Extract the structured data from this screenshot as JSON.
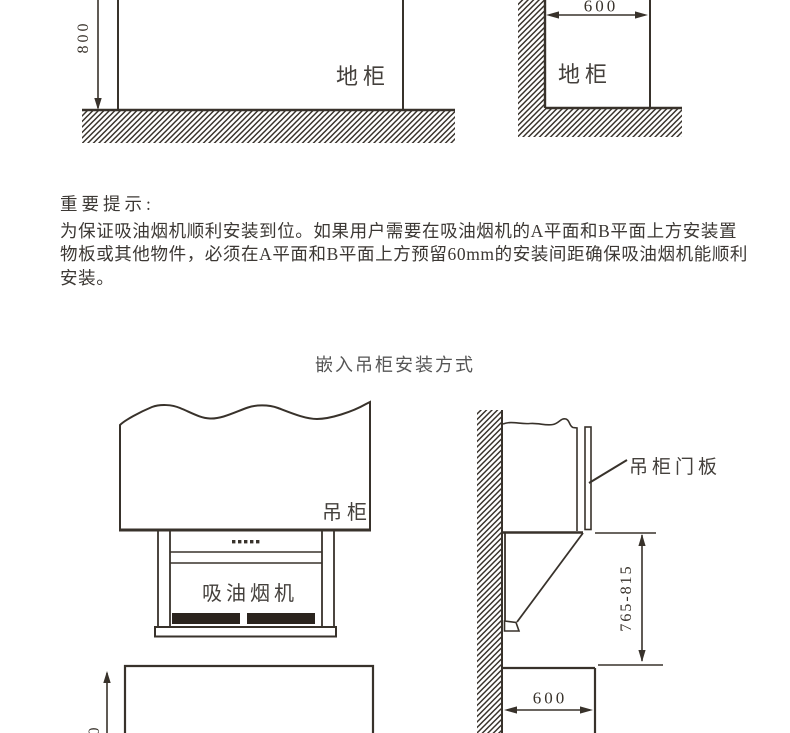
{
  "section_heading": "嵌入吊柜安装方式",
  "notice": {
    "title": "重要提示:",
    "lines": [
      "为保证吸油烟机顺利安装到位。如果用户需要在吸油烟机的A平面和B平面上方安装置",
      "物板或其他物件，必须在A平面和B平面上方预留60mm的安装间距确保吸油烟机能顺利",
      "安装。"
    ]
  },
  "top_left_diagram": {
    "height_dim": "800",
    "cabinet_label": "地柜"
  },
  "top_right_diagram": {
    "width_dim": "600",
    "cabinet_label": "地柜"
  },
  "front_view": {
    "cabinet_label": "吊柜",
    "hood_label": "吸油烟机",
    "height_dim": "800"
  },
  "side_view": {
    "door_panel_label": "吊柜门板",
    "install_height_dim": "765-815",
    "depth_dim": "600"
  },
  "colors": {
    "line": "#38322b",
    "text": "#3c3834",
    "heading": "#565656",
    "filter_dark": "#2b241e",
    "background": "#ffffff"
  }
}
